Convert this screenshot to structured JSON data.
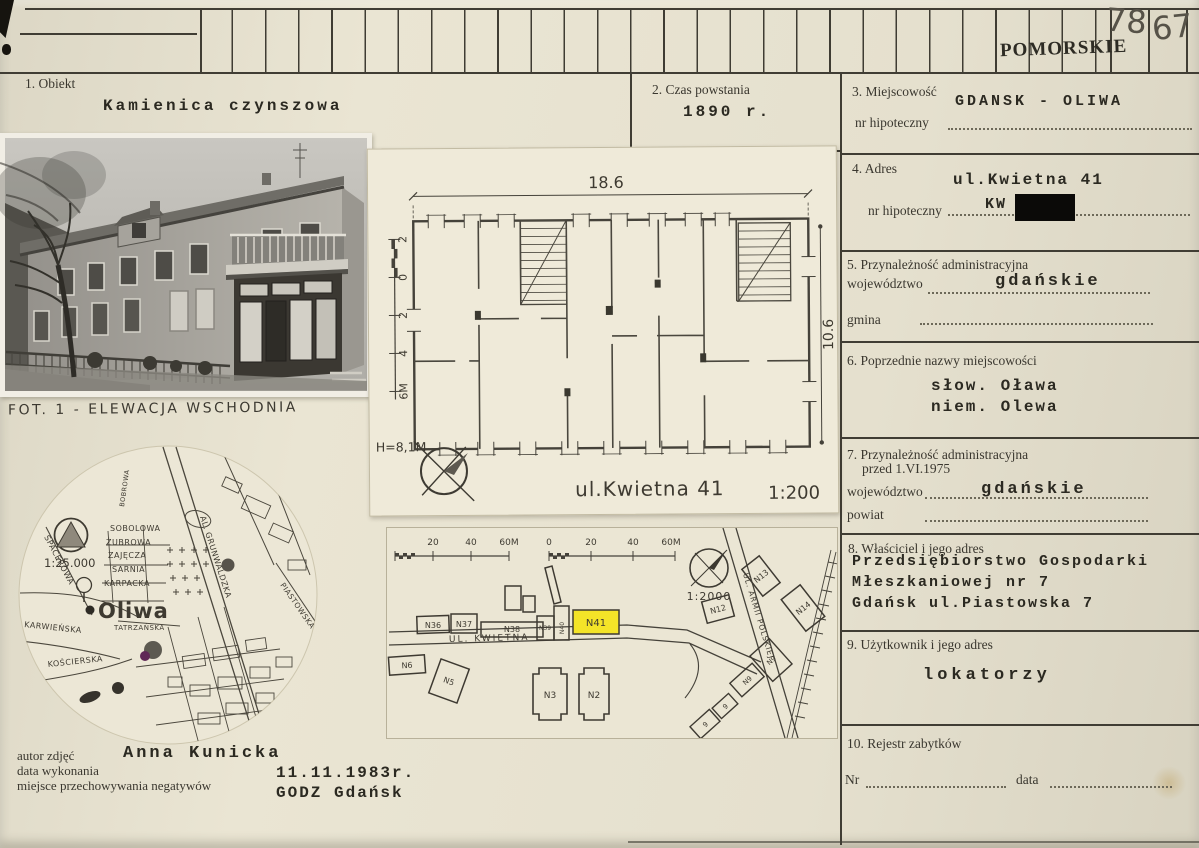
{
  "top_strip": {
    "stamp": "POMORSKIE",
    "num_left": "78",
    "num_right": "67"
  },
  "fields": {
    "obiekt": {
      "label": "1. Obiekt",
      "value": "Kamienica czynszowa"
    },
    "czas": {
      "label": "2. Czas powstania",
      "value": "1890 r."
    },
    "miejscowosc": {
      "label": "3. Miejscowość",
      "value": "GDANSK - OLIWA",
      "sub_label": "nr hipoteczny"
    },
    "adres": {
      "label": "4. Adres",
      "value": "ul.Kwietna 41",
      "sub_label": "nr hipoteczny",
      "sub_value": "KW"
    },
    "przynaleznosc": {
      "label": "5. Przynależność administracyjna",
      "row1_label": "województwo",
      "row1_value": "gdańskie",
      "row2_label": "gmina"
    },
    "poprzednie": {
      "label": "6. Poprzednie nazwy miejscowości",
      "line1": "słow. Oława",
      "line2": "niem. Olewa"
    },
    "przynaleznosc_1975": {
      "label": "7. Przynależność administracyjna",
      "label2": "przed 1.VI.1975",
      "row1_label": "województwo",
      "row1_value": "gdańskie",
      "row2_label": "powiat"
    },
    "wlasciciel": {
      "label": "8. Właściciel i jego adres",
      "line1": "Przedsiębiorstwo Gospodarki",
      "line2": "Młeszkaniowej nr 7",
      "line3": "Gdańsk ul.Piastowska 7"
    },
    "uzytkownik": {
      "label": "9. Użytkownik i jego adres",
      "value": "lokatorzy"
    },
    "rejestr": {
      "label": "10. Rejestr zabytków",
      "nr_label": "Nr",
      "data_label": "data"
    }
  },
  "photo": {
    "caption": "FOT. 1 - ELEWACJA WSCHODNIA"
  },
  "floorplan": {
    "dim_width": "18.6",
    "dim_height": "10.6",
    "ruler": [
      "2",
      "0",
      "2",
      "4",
      "6M"
    ],
    "height_label": "H=8,1M",
    "title": "ul.Kwietna 41",
    "scale_label": "1:200"
  },
  "city_map": {
    "scale_label": "1:25.000",
    "place": "Oliwa",
    "streets": [
      "SPACEROWA",
      "KARWIEŃSKA",
      "KOŚCIERSKA",
      "SOBOLOWA",
      "ŻUBROWA",
      "ZAJĘCZA",
      "SARNIA",
      "KARPACKA",
      "TATRZAŃSKA",
      "BOBROWA",
      "AL. GRUNWALDZKA",
      "PIASTOWSKA"
    ]
  },
  "site_plan": {
    "scale_label": "1:2000",
    "bar1": [
      "20",
      "40",
      "60M"
    ],
    "bar2": [
      "0",
      "20",
      "40",
      "60M"
    ],
    "street": "UL. KWIETNA",
    "street2": "UL. ARMII POLSKIEJ",
    "b": {
      "n36": "N36",
      "n37": "N37",
      "n38": "N38",
      "n39": "N39",
      "n40": "N40",
      "n41": "N41",
      "n12": "N12",
      "n13": "N13",
      "n14": "N14",
      "n6": "N6",
      "n5": "N5",
      "n3": "N3",
      "n2": "N2",
      "n9a": "N9",
      "n9b": "N9",
      "s9a": "9",
      "s9b": "9"
    }
  },
  "credits": {
    "author_label": "autor zdjęć",
    "author": "Anna Kunicka",
    "date_label": "data wykonania",
    "date": "11.11.1983r.",
    "neg_label": "miejsce przechowywania negatywów",
    "neg": "GODZ Gdańsk"
  }
}
